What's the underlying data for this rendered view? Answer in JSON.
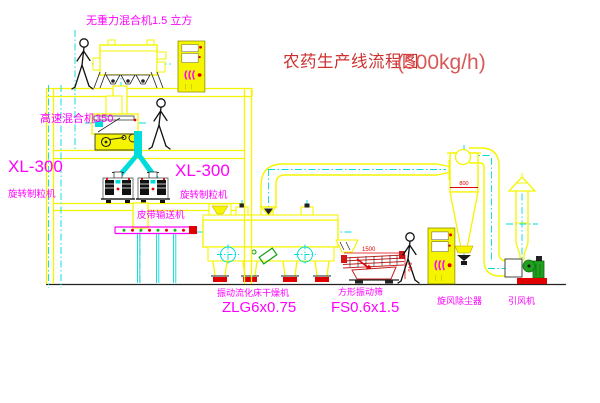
{
  "title": {
    "zh": "农药生产线流程图",
    "capacity": "(500kg/h)"
  },
  "labels": {
    "gravity_mixer": "无重力混合机1.5 立方",
    "high_speed_mixer": "高速混合机350",
    "granulator_left": {
      "model": "XL-300",
      "name": "旋转制粒机"
    },
    "granulator_mid": {
      "model": "XL-300",
      "name": "旋转制粒机"
    },
    "belt_conveyor": "皮带输送机",
    "dryer": {
      "name": "振动流化床干燥机",
      "model": "ZLG6x0.75"
    },
    "sieve": {
      "name": "方形振动筛",
      "model": "FS0.6x1.5"
    },
    "cyclone": "旋风除尘器",
    "fan": "引风机"
  },
  "dimensions": {
    "sieve_width": "1500",
    "sieve_height": "546",
    "cyclone_dia": "800"
  },
  "colors": {
    "line_yellow": "#f5f500",
    "centerline_cyan": "#00dcdc",
    "label_magenta": "#ff00ff",
    "title_red": "#cd2f2f",
    "detail_red": "#e00000",
    "machine_green": "#1fa11f"
  }
}
